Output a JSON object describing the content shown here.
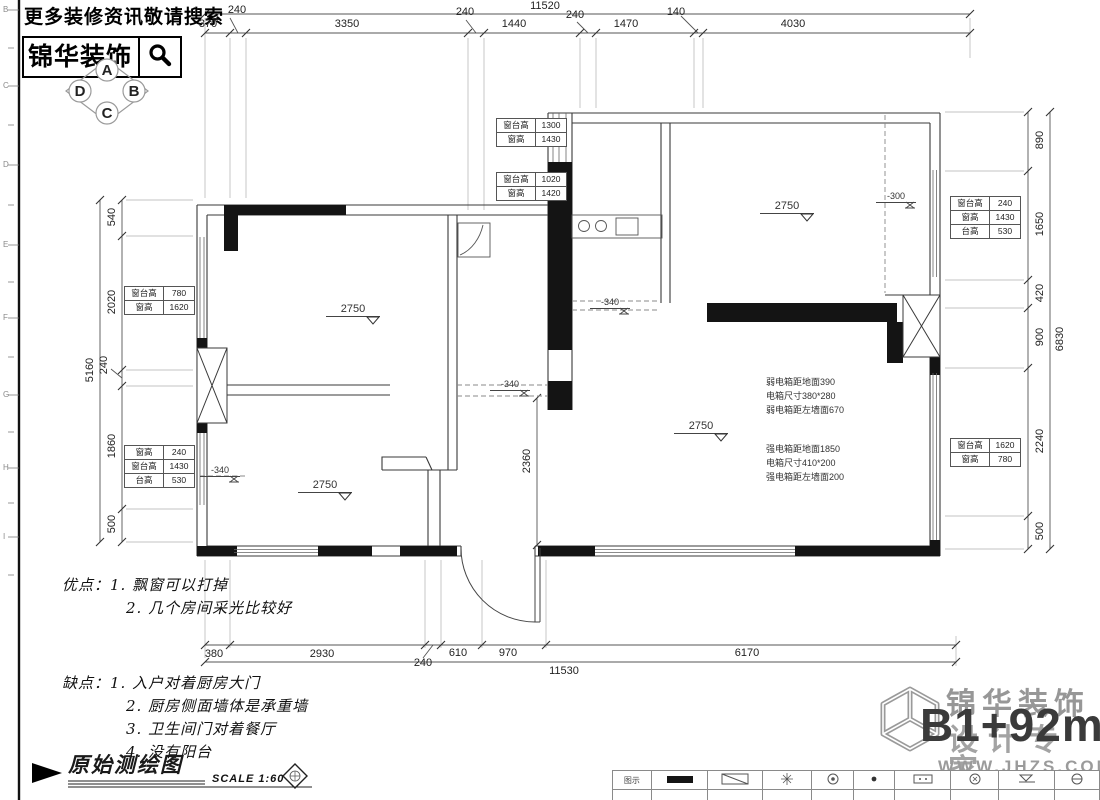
{
  "header": {
    "slogan": "更多装修资讯敬请搜索",
    "brand": "锦华装饰",
    "compass": {
      "a": "A",
      "b": "B",
      "c": "C",
      "d": "D"
    }
  },
  "ruler_letters": [
    "B",
    "C",
    "D",
    "E",
    "F",
    "G",
    "H",
    "I"
  ],
  "dims": {
    "top": {
      "total": "11520",
      "segments": [
        "370",
        "240",
        "3350",
        "240",
        "1440",
        "240",
        "1470",
        "140",
        "4030"
      ]
    },
    "bottom": {
      "total": "11530",
      "segments": [
        "380",
        "2930",
        "240",
        "610",
        "970",
        "6170"
      ]
    },
    "left": {
      "total": "5160",
      "extra": "240",
      "segments": [
        "540",
        "2020",
        "1860",
        "500"
      ]
    },
    "right": {
      "total": "6830",
      "segments": [
        "890",
        "1650",
        "420",
        "900",
        "2240",
        "500"
      ]
    },
    "entry_height": "2360"
  },
  "window_tables": [
    {
      "rows": [
        [
          "窗台高",
          "1300"
        ],
        [
          "窗高",
          "1430"
        ]
      ]
    },
    {
      "rows": [
        [
          "窗台高",
          "1020"
        ],
        [
          "窗高",
          "1420"
        ]
      ]
    },
    {
      "rows": [
        [
          "窗台高",
          "780"
        ],
        [
          "窗高",
          "1620"
        ]
      ]
    },
    {
      "rows": [
        [
          "窗高",
          "240"
        ],
        [
          "窗台高",
          "1430"
        ],
        [
          "台高",
          "530"
        ]
      ]
    },
    {
      "rows": [
        [
          "窗台高",
          "240"
        ],
        [
          "窗高",
          "1430"
        ],
        [
          "台高",
          "530"
        ]
      ]
    },
    {
      "rows": [
        [
          "窗台高",
          "1620"
        ],
        [
          "窗高",
          "780"
        ]
      ]
    }
  ],
  "level_markers": [
    "2750",
    "2750",
    "2750",
    "2750",
    "-300",
    "-340",
    "-340",
    "-340"
  ],
  "electrical": {
    "weak": [
      "弱电箱距地面390",
      "电箱尺寸380*280",
      "弱电箱距左墙面670"
    ],
    "strong": [
      "强电箱距地面1850",
      "电箱尺寸410*200",
      "强电箱距左墙面200"
    ]
  },
  "notes": {
    "pros_title": "优点：",
    "pros": [
      "1. 飘窗可以打掉",
      "2. 几个房间采光比较好"
    ],
    "cons_title": "缺点：",
    "cons": [
      "1. 入户对着厨房大门",
      "2. 厨房侧面墙体是承重墙",
      "3. 卫生间门对着餐厅",
      "4. 没有阳台"
    ]
  },
  "titleblock": {
    "title": "原始测绘图",
    "scale": "SCALE 1:60"
  },
  "watermark": {
    "brand": "锦华装饰",
    "tagline": "设计专家",
    "area": "B1+92m",
    "area_sup": "2",
    "site": "WWW.JHZS.COM"
  },
  "legend": {
    "header": "图示"
  },
  "icons": {
    "search": "magnifier",
    "logo": "cube-wireframe",
    "level": "down-triangle",
    "title_arrow": "filled-right-triangle"
  },
  "colors": {
    "wall_line": "#3a3a3a",
    "solid_wall": "#141414",
    "dim_line": "#555",
    "watermark_gray": "#979797"
  }
}
